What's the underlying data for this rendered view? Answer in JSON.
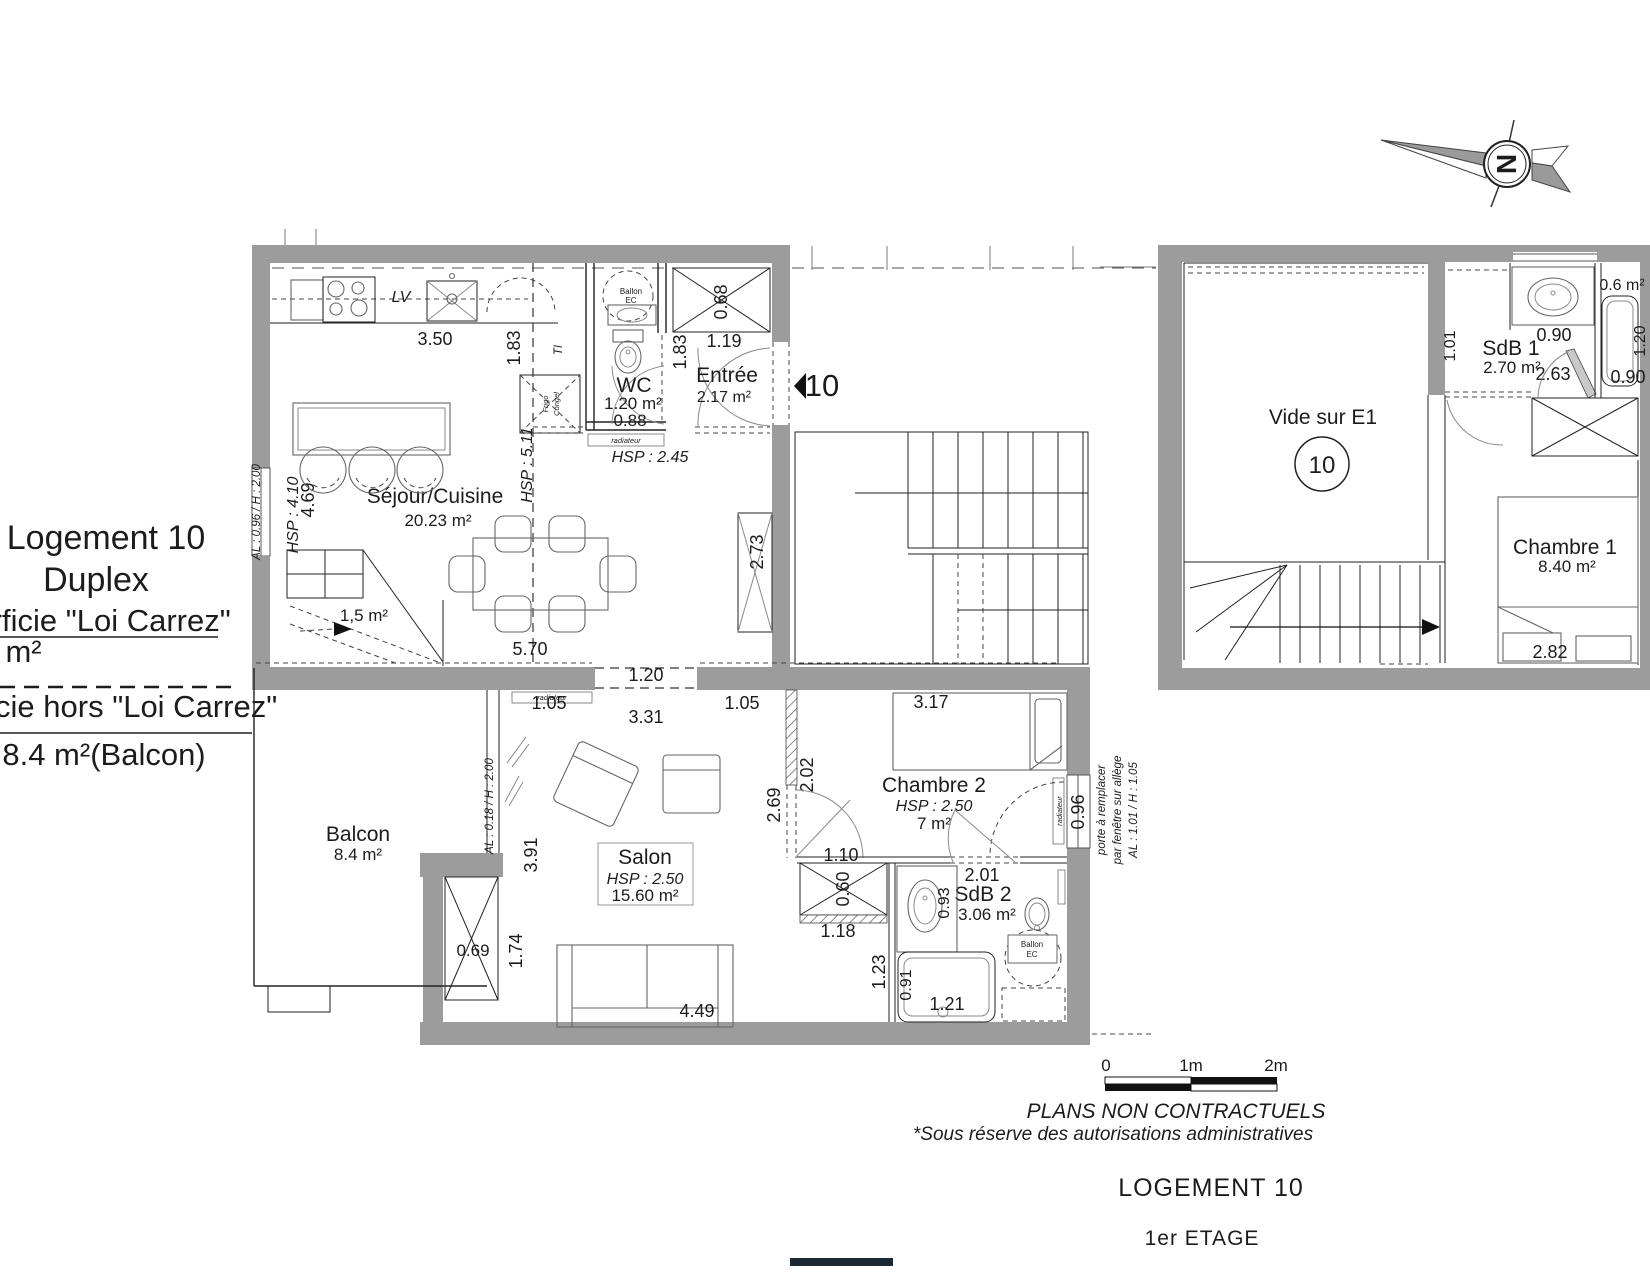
{
  "title_block": {
    "line1": "Logement 10",
    "line2": "Duplex",
    "carrez_label": "Superficie \"Loi Carrez\"",
    "carrez_value": "36 m²",
    "hors_label": "Superficie hors \"Loi Carrez\"",
    "hors_value": "8.4 m²(Balcon)"
  },
  "compass": {
    "north": "N"
  },
  "entrance_marker": {
    "number": "10"
  },
  "level1": {
    "sejour": {
      "name": "Séjour/Cuisine",
      "area": "20.23 m²",
      "hsp_main": "HSP : 4.10",
      "hsp_kitchen": "HSP : 5.11",
      "hsp_hall": "HSP : 2.45",
      "lv": "LV",
      "ti": "TI",
      "fridge_line1": "Frigo",
      "fridge_line2": "Congel",
      "stair_area": "1,5 m²",
      "window_note": "AL : 0.96 / H : 2.00",
      "radiator": "radiateur"
    },
    "wc": {
      "name": "WC",
      "area": "1.20 m²",
      "door": "0.88",
      "ballon_line1": "Ballon",
      "ballon_line2": "EC"
    },
    "entree": {
      "name": "Entrée",
      "area": "2.17 m²"
    },
    "balcon": {
      "name": "Balcon",
      "area": "8.4 m²",
      "window_note": "AL : 0.18 / H : 2.00"
    },
    "salon": {
      "name": "Salon",
      "hsp": "HSP : 2.50",
      "area": "15.60 m²",
      "radiator": "radiateur"
    },
    "chambre2": {
      "name": "Chambre 2",
      "hsp": "HSP : 2.50",
      "area": "7 m²",
      "radiator": "radiateur",
      "note_line1": "porte à remplacer",
      "note_line2": "par fenêtre sur allège",
      "note_line3": "AL : 1.01 / H : 1.05"
    },
    "sdb2": {
      "name": "SdB 2",
      "area": "3.06 m²",
      "ballon_line1": "Ballon",
      "ballon_line2": "EC"
    }
  },
  "level2": {
    "vide": {
      "name": "Vide sur E1",
      "number": "10"
    },
    "sdb1": {
      "name": "SdB 1",
      "area": "2.70 m²"
    },
    "douche": {
      "area": "0.6 m²"
    },
    "chambre1": {
      "name": "Chambre 1",
      "area": "8.40 m²"
    }
  },
  "dims": {
    "k350": "3.50",
    "k183": "1.83",
    "e183": "1.83",
    "e119": "1.19",
    "e068": "0.68",
    "s469": "4.69",
    "s570": "5.70",
    "s273": "2.73",
    "o120": "1.20",
    "l105a": "1.05",
    "l331": "3.31",
    "l105b": "1.05",
    "b391": "3.91",
    "b174": "1.74",
    "b069": "0.69",
    "sa449": "4.49",
    "sa269": "2.69",
    "sa123": "1.23",
    "sa118": "1.18",
    "sa060": "0.60",
    "sa110": "1.10",
    "c2_317": "3.17",
    "c2_202": "2.02",
    "c2_096": "0.96",
    "s2_201": "2.01",
    "s2_093": "0.93",
    "s2_091": "0.91",
    "s2_121": "1.21",
    "s1_090a": "0.90",
    "s1_263": "2.63",
    "s1_101": "1.01",
    "s1_120": "1.20",
    "s1_090b": "0.90",
    "c1_282": "2.82"
  },
  "scale_bar": {
    "t0": "0",
    "t1": "1m",
    "t2": "2m"
  },
  "footer": {
    "disclaimer1": "PLANS NON CONTRACTUELS",
    "disclaimer2": "*Sous réserve des autorisations administratives",
    "unit_label": "LOGEMENT 10",
    "floor_label": "1er ETAGE"
  }
}
